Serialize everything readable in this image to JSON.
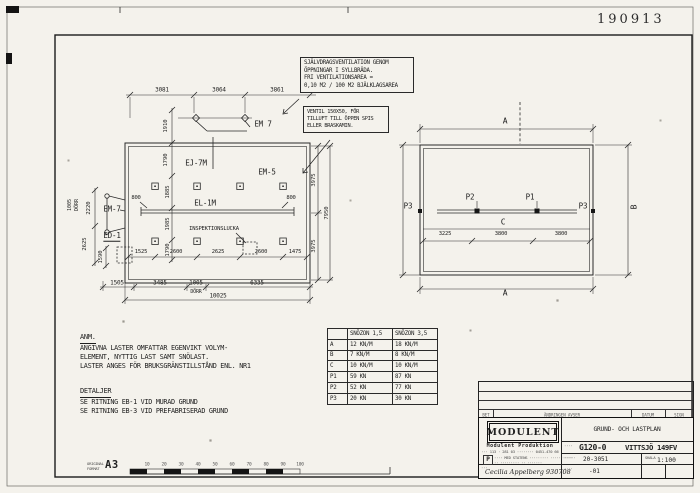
{
  "sheet": {
    "stamp": "190913",
    "format_l1": "ORIGINAL",
    "format_l2": "FORMAT",
    "format": "A3",
    "ruler": [
      "10",
      "20",
      "30",
      "40",
      "50",
      "60",
      "70",
      "80",
      "90",
      "100"
    ],
    "paper_color": "#f4f2ec",
    "line_color": "#2a2a2a"
  },
  "notes": {
    "vent_box": [
      "SJÄLVDRAGSVENTILATION GENOM",
      "ÖPPNINGAR I SYLLBRÄDA.",
      "FRI VENTILATIONSAREA =",
      "0,10 M2 / 100 M2 BJÄLKLAGSAREA"
    ],
    "vent_small": [
      "VENTIL 150X50, FÖR",
      "TILLUFT TILL ÖPPEN SPIS",
      "ELLER BRASKAMIN."
    ],
    "anm_h": "ANM.",
    "anm": [
      "ANGIVNA LASTER OMFATTAR EGENVIKT VOLYM-",
      "ELEMENT, NYTTIG LAST SAMT SNÖLAST.",
      "LASTER ANGES FÖR BRUKSGRÄNSTILLSTÅND ENL. NR1"
    ],
    "det_h": "DETALJER",
    "det": [
      "SE RITNING EB-1 VID MURAD GRUND",
      "SE RITNING EB-3 VID PREFABRISERAD GRUND"
    ]
  },
  "lp": {
    "top_dims": [
      "3081",
      "3064",
      "3861"
    ],
    "chain_dims": [
      "1910",
      "1790",
      "1885",
      "1985",
      "1790"
    ],
    "left_dims": [
      "2220",
      "2625",
      "1590"
    ],
    "left_door_dim": "1005",
    "left_door_label": "DÖRR",
    "right_dims": [
      "3975",
      "3975"
    ],
    "right_total": "7950",
    "pad_dims": [
      "1525",
      "2600",
      "2625",
      "2600",
      "1475"
    ],
    "bottom_dims": [
      "1505",
      "3485",
      "1005",
      "6335"
    ],
    "bottom_door_label": "DÖRR",
    "bottom_total": "10025",
    "beam_offsets": [
      "800",
      "800"
    ],
    "em7_top": "EM 7",
    "ej7m": "EJ-7M",
    "em5": "EM-5",
    "em7": "EM-7",
    "ed1": "ED-1",
    "el1m": "EL-1M",
    "hatch": "INSPEKTIONSLUCKA"
  },
  "rp": {
    "a": "A",
    "b": "B",
    "c": "C",
    "p1": "P1",
    "p2": "P2",
    "p3": "P3",
    "dims": [
      "3225",
      "3800",
      "3800"
    ]
  },
  "table": {
    "headers": [
      "SNÖZON 1,5",
      "SNÖZON 3,5"
    ],
    "rows": [
      [
        "A",
        "12 KN/M",
        "18 KN/M"
      ],
      [
        "B",
        "7 KN/M",
        "8 KN/M"
      ],
      [
        "C",
        "10 KN/M",
        "10 KN/M"
      ],
      [
        "P1",
        "59 KN",
        "87 KN"
      ],
      [
        "P2",
        "52 KN",
        "77 KN"
      ],
      [
        "P3",
        "20 KN",
        "30 KN"
      ]
    ]
  },
  "rev": {
    "bet": "BET",
    "desc": "ÄNDRINGEN AVSER",
    "datum": "DATUM",
    "sign": "SIGN"
  },
  "tb": {
    "company": "MODULENT",
    "sub": "Modulent Produktion",
    "addr": "··· 113 · 281 03 ········ 0451-470 66",
    "cert_p": "P",
    "cert1": "···· MED STATENS ········· ············",
    "cert2": "·· ········· ·· ·······",
    "title": "GRUND- OCH LASTPLAN",
    "code": "G120-0",
    "object": "VITTSJÖ 149FV",
    "proj": "20-3051",
    "scale_l": "SKALA",
    "scale": "1:100",
    "sheet_no": "-01",
    "sig": "Cecilia Appelberg   930708",
    "micro1": "····",
    "micro2": "····",
    "micro3": "····",
    "micro4": "···"
  }
}
